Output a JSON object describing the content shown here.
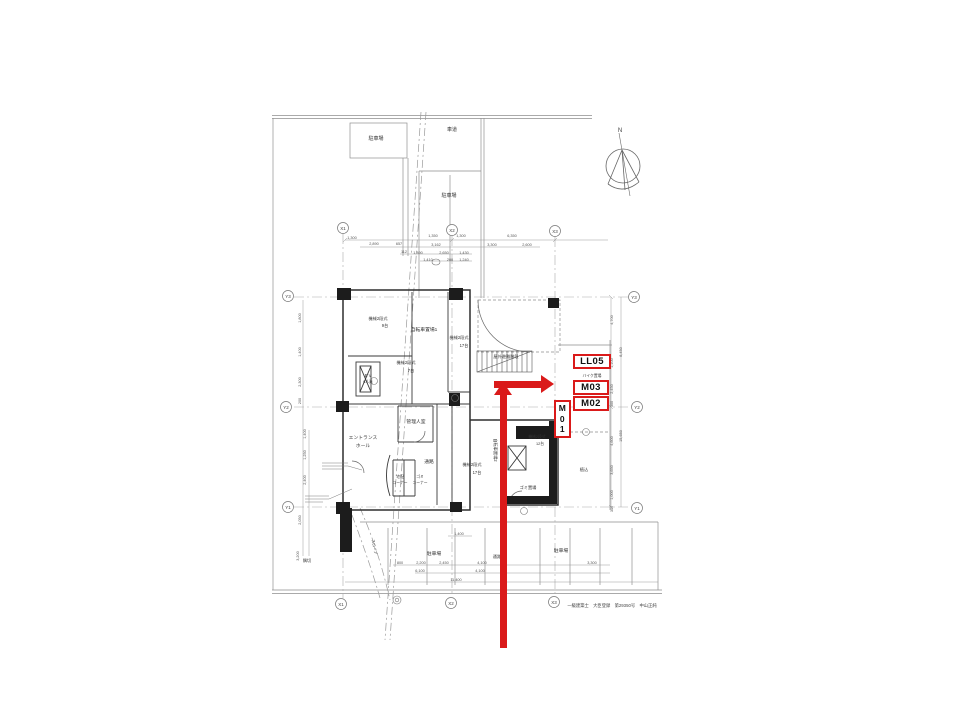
{
  "page": {
    "background": "#ffffff"
  },
  "compass": {
    "label": "N"
  },
  "title_block": {
    "t": "一級建築士　大臣登録　第29350号　中山正純"
  },
  "annotations": {
    "color": "#da1a1a",
    "boxes": [
      {
        "label": "LL05",
        "display": "LL05",
        "x": 573,
        "y": 354,
        "w": 38,
        "h": 15,
        "vertical": false
      },
      {
        "label": "M03",
        "display": "M03",
        "x": 573,
        "y": 380,
        "w": 36,
        "h": 15,
        "vertical": false
      },
      {
        "label": "M02",
        "display": "M02",
        "x": 573,
        "y": 396,
        "w": 36,
        "h": 15,
        "vertical": false
      },
      {
        "label": "M01",
        "display": "M\n0\n1",
        "x": 554,
        "y": 400,
        "w": 17,
        "h": 38,
        "vertical": true
      }
    ],
    "arrows": [
      {
        "name": "annotation-arrow-right",
        "direction": "right"
      },
      {
        "name": "annotation-arrow-up",
        "direction": "up"
      }
    ]
  },
  "plan": {
    "grid_bubbles": [
      {
        "label": "X1",
        "x": 343,
        "y": 228
      },
      {
        "label": "X2",
        "x": 452,
        "y": 230
      },
      {
        "label": "X3",
        "x": 555,
        "y": 231
      },
      {
        "label": "X1",
        "x": 341,
        "y": 604
      },
      {
        "label": "X2",
        "x": 451,
        "y": 603
      },
      {
        "label": "X3",
        "x": 554,
        "y": 602
      },
      {
        "label": "Y3",
        "x": 288,
        "y": 296
      },
      {
        "label": "Y2",
        "x": 286,
        "y": 407
      },
      {
        "label": "Y1",
        "x": 288,
        "y": 507
      },
      {
        "label": "Y3",
        "x": 634,
        "y": 297
      },
      {
        "label": "Y2",
        "x": 637,
        "y": 407
      },
      {
        "label": "Y1",
        "x": 637,
        "y": 508
      }
    ],
    "room_labels": [
      {
        "t": "駐車場",
        "x": 376,
        "y": 140,
        "fs": 5
      },
      {
        "t": "車道",
        "x": 452,
        "y": 131,
        "fs": 5
      },
      {
        "t": "駐車場",
        "x": 449,
        "y": 197,
        "fs": 5
      },
      {
        "t": "機械2段式",
        "x": 378,
        "y": 320,
        "fs": 4.2
      },
      {
        "t": "9台",
        "x": 385,
        "y": 327,
        "fs": 4.2
      },
      {
        "t": "自転車置場1",
        "x": 424,
        "y": 331,
        "fs": 4.8
      },
      {
        "t": "機械2段式",
        "x": 459,
        "y": 339,
        "fs": 4.2
      },
      {
        "t": "17台",
        "x": 464,
        "y": 347,
        "fs": 4.2
      },
      {
        "t": "E V",
        "x": 368,
        "y": 377,
        "fs": 4.2
      },
      {
        "t": "6人乗",
        "x": 368,
        "y": 383,
        "fs": 3.8
      },
      {
        "t": "機械2段式",
        "x": 406,
        "y": 364,
        "fs": 4.2
      },
      {
        "t": "7台",
        "x": 411,
        "y": 372,
        "fs": 4.2
      },
      {
        "t": "屋外避難階段",
        "x": 506,
        "y": 358,
        "fs": 4.2
      },
      {
        "t": "管理人室",
        "x": 416,
        "y": 423,
        "fs": 4.8
      },
      {
        "t": "エントランス",
        "x": 363,
        "y": 439,
        "fs": 4.8
      },
      {
        "t": "ホール",
        "x": 363,
        "y": 447,
        "fs": 4.8
      },
      {
        "t": "通路",
        "x": 429,
        "y": 463,
        "fs": 4.8
      },
      {
        "t": "宅配",
        "x": 400,
        "y": 478,
        "fs": 3.8
      },
      {
        "t": "コーナー",
        "x": 400,
        "y": 484,
        "fs": 3.8
      },
      {
        "t": "ゴミ",
        "x": 420,
        "y": 478,
        "fs": 3.8
      },
      {
        "t": "コーナー",
        "x": 420,
        "y": 484,
        "fs": 3.8
      },
      {
        "t": "機械2段式",
        "x": 472,
        "y": 466,
        "fs": 4.2
      },
      {
        "t": "17台",
        "x": 477,
        "y": 474,
        "fs": 4.2
      },
      {
        "t": "自転車置場2",
        "x": 494,
        "y": 450,
        "fs": 4.2,
        "r": 90
      },
      {
        "t": "機械2段式",
        "x": 537,
        "y": 438,
        "fs": 3.8
      },
      {
        "t": "12台",
        "x": 540,
        "y": 445,
        "fs": 3.8
      },
      {
        "t": "ゴミ置場",
        "x": 528,
        "y": 489,
        "fs": 4.2
      },
      {
        "t": "植込",
        "x": 584,
        "y": 471,
        "fs": 4.2
      },
      {
        "t": "隅切",
        "x": 307,
        "y": 562,
        "fs": 4.2
      },
      {
        "t": "スロープ",
        "x": 373,
        "y": 547,
        "fs": 3.8,
        "r": 78
      },
      {
        "t": "駐車場",
        "x": 434,
        "y": 555,
        "fs": 4.8
      },
      {
        "t": "駐車場",
        "x": 561,
        "y": 552,
        "fs": 4.8
      },
      {
        "t": "通路",
        "x": 497,
        "y": 558,
        "fs": 4.2
      },
      {
        "t": "バイク置場",
        "x": 592,
        "y": 377,
        "fs": 3.8
      }
    ],
    "dim_labels": [
      {
        "t": "1,300",
        "x": 352,
        "y": 239
      },
      {
        "t": "1,350",
        "x": 433,
        "y": 237
      },
      {
        "t": "1,300",
        "x": 461,
        "y": 237
      },
      {
        "t": "6,350",
        "x": 512,
        "y": 237
      },
      {
        "t": "2,890",
        "x": 374,
        "y": 245
      },
      {
        "t": "657",
        "x": 399,
        "y": 245
      },
      {
        "t": "3,162",
        "x": 436,
        "y": 246
      },
      {
        "t": "3,300",
        "x": 492,
        "y": 246
      },
      {
        "t": "2,600",
        "x": 527,
        "y": 246
      },
      {
        "t": "112",
        "x": 404,
        "y": 253
      },
      {
        "t": "1,890",
        "x": 418,
        "y": 254
      },
      {
        "t": "2,650",
        "x": 444,
        "y": 254
      },
      {
        "t": "1,430",
        "x": 464,
        "y": 254
      },
      {
        "t": "1,410",
        "x": 428,
        "y": 261
      },
      {
        "t": "200",
        "x": 450,
        "y": 261
      },
      {
        "t": "1,240",
        "x": 464,
        "y": 261
      },
      {
        "t": "4,700",
        "x": 613,
        "y": 320,
        "r": -90
      },
      {
        "t": "8,450",
        "x": 622,
        "y": 352,
        "r": -90
      },
      {
        "t": "1,100",
        "x": 613,
        "y": 363,
        "r": -90
      },
      {
        "t": "2,450",
        "x": 613,
        "y": 389,
        "r": -90
      },
      {
        "t": "300",
        "x": 613,
        "y": 404,
        "r": -90
      },
      {
        "t": "15,650",
        "x": 622,
        "y": 436,
        "r": -90
      },
      {
        "t": "4,600",
        "x": 613,
        "y": 441,
        "r": -90
      },
      {
        "t": "3,650",
        "x": 613,
        "y": 470,
        "r": -90
      },
      {
        "t": "1,000",
        "x": 613,
        "y": 495,
        "r": -90
      },
      {
        "t": "300",
        "x": 613,
        "y": 509,
        "r": -90
      },
      {
        "t": "1,800",
        "x": 301,
        "y": 318,
        "r": -90
      },
      {
        "t": "1,400",
        "x": 301,
        "y": 352,
        "r": -90
      },
      {
        "t": "2,300",
        "x": 301,
        "y": 382,
        "r": -90
      },
      {
        "t": "200",
        "x": 301,
        "y": 401,
        "r": -90
      },
      {
        "t": "1,400",
        "x": 306,
        "y": 434,
        "r": -90
      },
      {
        "t": "1,250",
        "x": 306,
        "y": 455,
        "r": -90
      },
      {
        "t": "2,400",
        "x": 306,
        "y": 480,
        "r": -90
      },
      {
        "t": "2,050",
        "x": 301,
        "y": 520,
        "r": -90
      },
      {
        "t": "3,200",
        "x": 299,
        "y": 556,
        "r": -90
      },
      {
        "t": "1,400",
        "x": 459,
        "y": 535
      },
      {
        "t": "800",
        "x": 400,
        "y": 564
      },
      {
        "t": "2,200",
        "x": 421,
        "y": 564
      },
      {
        "t": "2,450",
        "x": 444,
        "y": 564
      },
      {
        "t": "4,100",
        "x": 482,
        "y": 564
      },
      {
        "t": "3,300",
        "x": 592,
        "y": 564
      },
      {
        "t": "6,100",
        "x": 420,
        "y": 572
      },
      {
        "t": "4,100",
        "x": 480,
        "y": 572
      },
      {
        "t": "11,400",
        "x": 456,
        "y": 581
      }
    ]
  }
}
